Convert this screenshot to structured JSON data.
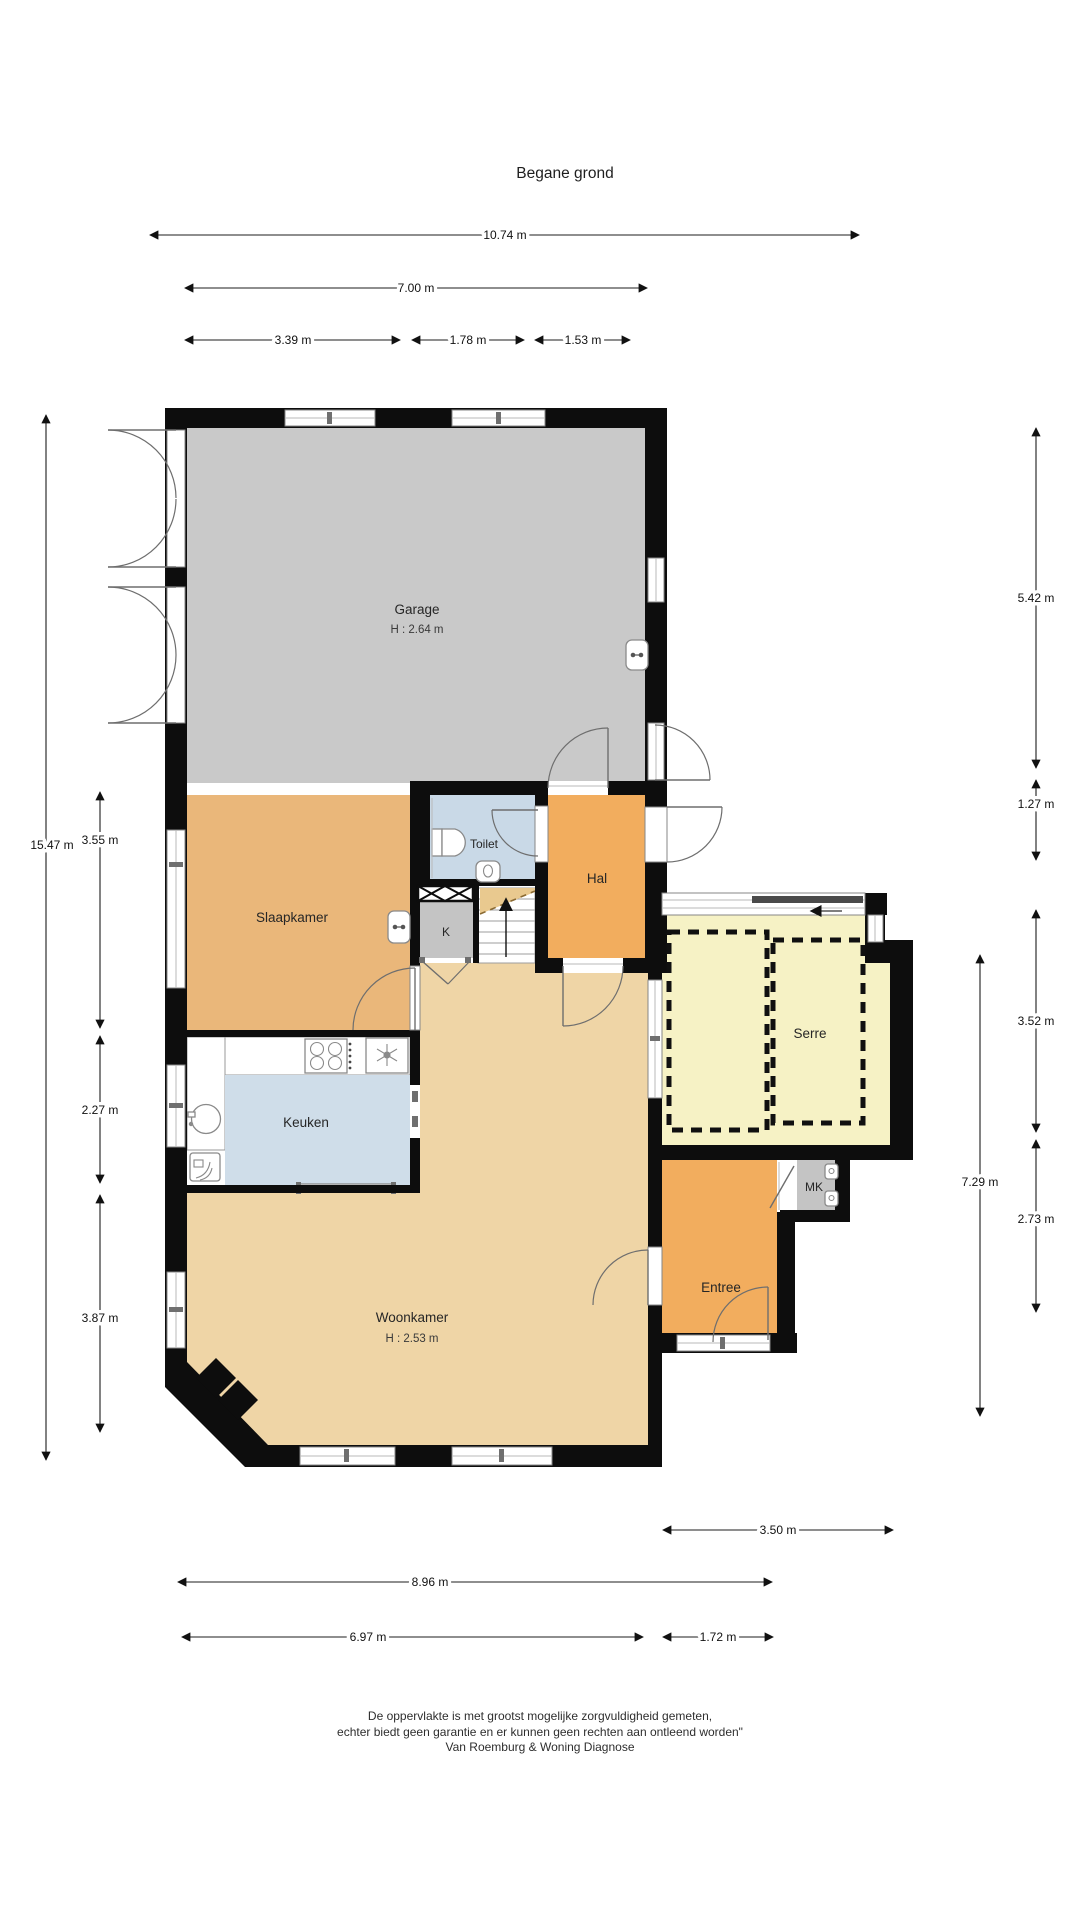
{
  "title": "Begane grond",
  "rooms": {
    "garage": {
      "name": "Garage",
      "height": "H : 2.64 m"
    },
    "slaapkamer": {
      "name": "Slaapkamer"
    },
    "toilet": {
      "name": "Toilet"
    },
    "kast": {
      "name": "K"
    },
    "hal": {
      "name": "Hal"
    },
    "keuken": {
      "name": "Keuken"
    },
    "serre": {
      "name": "Serre"
    },
    "meterkast": {
      "name": "MK"
    },
    "entree": {
      "name": "Entree"
    },
    "woonkamer": {
      "name": "Woonkamer",
      "height": "H : 2.53 m"
    }
  },
  "dimensions": {
    "top": [
      {
        "label": "10.74 m"
      },
      {
        "label": "7.00 m"
      },
      {
        "label": "3.39 m"
      },
      {
        "label": "1.78 m"
      },
      {
        "label": "1.53 m"
      }
    ],
    "left": [
      {
        "label": "15.47 m"
      },
      {
        "label": "3.55 m"
      },
      {
        "label": "2.27 m"
      },
      {
        "label": "3.87 m"
      }
    ],
    "right": [
      {
        "label": "5.42 m"
      },
      {
        "label": "1.27 m"
      },
      {
        "label": "3.52 m"
      },
      {
        "label": "7.29 m"
      },
      {
        "label": "2.73 m"
      }
    ],
    "bottom": [
      {
        "label": "3.50 m"
      },
      {
        "label": "8.96 m"
      },
      {
        "label": "6.97 m"
      },
      {
        "label": "1.72 m"
      }
    ]
  },
  "footer": {
    "line1": "De oppervlakte is met grootst mogelijke zorgvuldigheid gemeten,",
    "line2": "echter biedt geen garantie en er kunnen geen rechten aan ontleend worden\"",
    "line3": "Van Roemburg & Woning Diagnose"
  },
  "colors": {
    "wall": "#0d0d0d",
    "garage": "#c9c9c9",
    "slaapkamer": "#eab77a",
    "hal": "#f2ad5e",
    "entree": "#f2ad5e",
    "woonkamer": "#efd5a6",
    "keuken": "#cfdde9",
    "toilet": "#c9d9e7",
    "serre": "#f6f2c5",
    "kast": "#c4c4c4",
    "meterkast": "#c4c4c4",
    "stairs_overhead": "#e9c98f"
  }
}
